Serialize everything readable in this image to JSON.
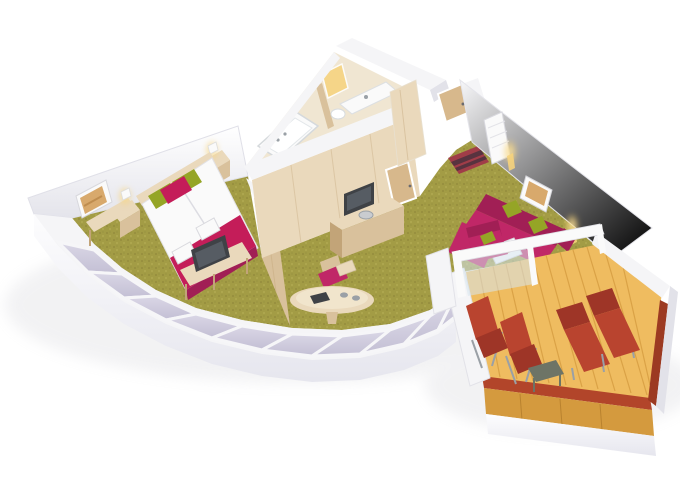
{
  "scene": {
    "type": "isometric-3d-floorplan-render",
    "subject": "hotel-suite-with-balcony",
    "rooms": [
      {
        "id": "bedroom",
        "items": [
          "double-bed",
          "headboard",
          "green-pillow",
          "green-pillow",
          "red-pillow",
          "bed-runner",
          "towel-set",
          "towel-set",
          "nightstand",
          "nightstand",
          "bedside-lamp",
          "bedside-lamp",
          "foot-bench",
          "television",
          "console-table",
          "wall-picture"
        ]
      },
      {
        "id": "bathroom",
        "items": [
          "bathtub",
          "faucet",
          "vanity-sink",
          "lit-mirror",
          "toilet",
          "partition-wall"
        ]
      },
      {
        "id": "entrance-hall",
        "items": [
          "entrance-door",
          "striped-doormat",
          "wardrobe",
          "interior-door"
        ]
      },
      {
        "id": "living-room",
        "items": [
          "corner-sofa",
          "green-cushion",
          "green-cushion",
          "coffee-table",
          "book",
          "armchair",
          "ottoman",
          "wall-television",
          "sideboard",
          "wall-picture",
          "sconce-lamp",
          "sconce-lamp",
          "louvered-closet"
        ]
      },
      {
        "id": "dining-area",
        "items": [
          "oval-table",
          "dining-chair",
          "tray-with-cups",
          "dark-folder",
          "divider-wall",
          "floor-stool"
        ]
      },
      {
        "id": "balcony",
        "items": [
          "deck-chair",
          "deck-chair",
          "sun-lounger",
          "sun-lounger",
          "side-table",
          "glass-sliding-door",
          "red-railing",
          "wood-deck"
        ]
      }
    ],
    "window_pane_count": 10
  },
  "colors": {
    "background": "#ffffff",
    "carpet": "#a39c45",
    "carpet_shade": "#8d8536",
    "wall_white": "#f5f5f7",
    "wall_shade": "#e2e2e9",
    "hull": "#f2f2f6",
    "pane": "#cfcbdc",
    "wood_light": "#ead9bc",
    "wood_mid": "#d9c19c",
    "wood_dark": "#c2a478",
    "wood_door": "#d7b88c",
    "wood_floor": "#f0e6d2",
    "magenta": "#c02767",
    "magenta_dark": "#a11f55",
    "runner": "#c41d59",
    "green": "#95a526",
    "tv_dark": "#3f4246",
    "tv_screen": "#565c63",
    "lamp_glow": "#f6d37c",
    "deck": "#efbc60",
    "deck_plank": "#d49a3e",
    "rail_red": "#b2452a",
    "rail_red_dark": "#9c3a22",
    "lounger": "#b9442f",
    "lounger_dark": "#9e3527",
    "mat_red": "#a03d48",
    "mat_dark": "#57333f",
    "glass": "#d7e5ee",
    "metal": "#9aa0a6",
    "white_soft": "#fafafa",
    "art": "#d8a96c",
    "table_gray": "#6d7466",
    "shadow": "#b9b9c2"
  }
}
